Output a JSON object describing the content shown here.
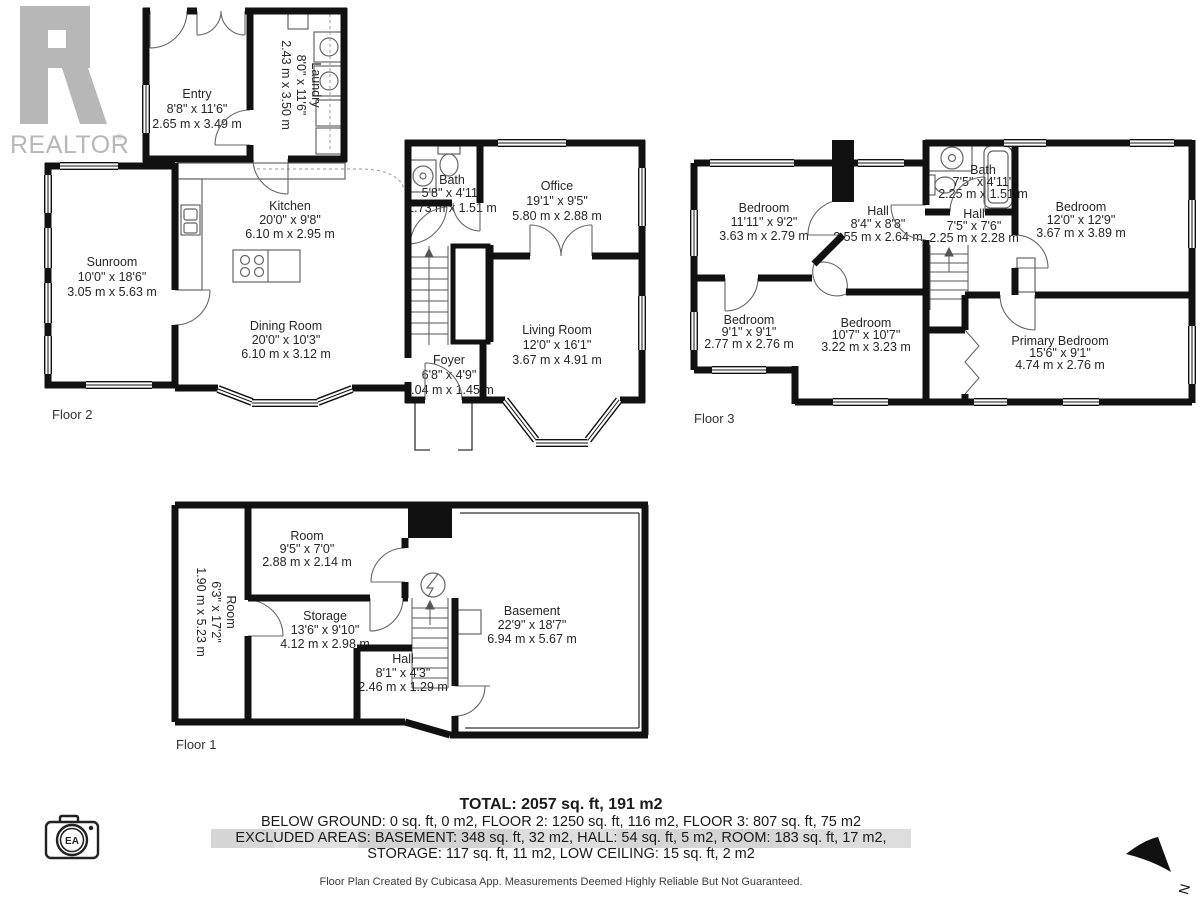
{
  "branding": {
    "realtor_text": "REALTOR",
    "registered_mark": "®",
    "camera_badge": "EA"
  },
  "compass": {
    "north_label": "N"
  },
  "floors": [
    {
      "label": "Floor 2",
      "rooms": [
        {
          "name": "Entry",
          "imperial": "8'8\" x 11'6\"",
          "metric": "2.65 m x 3.49 m"
        },
        {
          "name": "Laundry",
          "imperial": "8'0\" x 11'6\"",
          "metric": "2.43 m x 3.50 m"
        },
        {
          "name": "Kitchen",
          "imperial": "20'0\" x 9'8\"",
          "metric": "6.10 m x 2.95 m"
        },
        {
          "name": "Sunroom",
          "imperial": "10'0\" x 18'6\"",
          "metric": "3.05 m x 5.63 m"
        },
        {
          "name": "Dining Room",
          "imperial": "20'0\" x 10'3\"",
          "metric": "6.10 m x 3.12 m"
        },
        {
          "name": "Bath",
          "imperial": "5'8\" x 4'11\"",
          "metric": "1.73 m x 1.51 m"
        },
        {
          "name": "Office",
          "imperial": "19'1\" x 9'5\"",
          "metric": "5.80 m x 2.88 m"
        },
        {
          "name": "Living Room",
          "imperial": "12'0\" x 16'1\"",
          "metric": "3.67 m x 4.91 m"
        },
        {
          "name": "Foyer",
          "imperial": "6'8\" x 4'9\"",
          "metric": "2.04 m x 1.45 m"
        }
      ]
    },
    {
      "label": "Floor 3",
      "rooms": [
        {
          "name": "Bedroom",
          "imperial": "11'11\" x 9'2\"",
          "metric": "3.63 m x 2.79 m"
        },
        {
          "name": "Hall",
          "imperial": "8'4\" x 8'8\"",
          "metric": "2.55 m x 2.64 m"
        },
        {
          "name": "Bath",
          "imperial": "7'5\" x 4'11\"",
          "metric": "2.25 m x 1.51 m"
        },
        {
          "name": "Hall",
          "imperial": "7'5\" x 7'6\"",
          "metric": "2.25 m x 2.28 m"
        },
        {
          "name": "Bedroom",
          "imperial": "12'0\" x 12'9\"",
          "metric": "3.67 m x 3.89 m"
        },
        {
          "name": "Bedroom",
          "imperial": "9'1\" x 9'1\"",
          "metric": "2.77 m x 2.76 m"
        },
        {
          "name": "Bedroom",
          "imperial": "10'7\" x 10'7\"",
          "metric": "3.22 m x 3.23 m"
        },
        {
          "name": "Primary Bedroom",
          "imperial": "15'6\" x 9'1\"",
          "metric": "4.74 m x 2.76 m"
        }
      ]
    },
    {
      "label": "Floor 1",
      "rooms": [
        {
          "name": "Room",
          "imperial": "9'5\" x 7'0\"",
          "metric": "2.88 m x 2.14 m"
        },
        {
          "name": "Room",
          "imperial": "6'3\" x 17'2\"",
          "metric": "1.90 m x 5.23 m"
        },
        {
          "name": "Storage",
          "imperial": "13'6\" x 9'10\"",
          "metric": "4.12 m x 2.98 m"
        },
        {
          "name": "Hall",
          "imperial": "8'1\" x 4'3\"",
          "metric": "2.46 m x 1.29 m"
        },
        {
          "name": "Basement",
          "imperial": "22'9\" x 18'7\"",
          "metric": "6.94 m x 5.67 m"
        }
      ]
    }
  ],
  "summary": {
    "total": "TOTAL: 2057 sq. ft, 191 m2",
    "line1": "BELOW GROUND: 0 sq. ft, 0 m2, FLOOR 2: 1250 sq. ft, 116 m2, FLOOR 3: 807 sq. ft, 75 m2",
    "line2": "EXCLUDED AREAS: BASEMENT: 348 sq. ft, 32 m2, HALL: 54 sq. ft, 5 m2, ROOM: 183 sq. ft, 17 m2,",
    "line3": "STORAGE: 117 sq. ft, 11 m2, LOW CEILING: 15 sq. ft, 2 m2",
    "disclaimer": "Floor Plan Created By Cubicasa App. Measurements Deemed Highly Reliable But Not Guaranteed."
  }
}
